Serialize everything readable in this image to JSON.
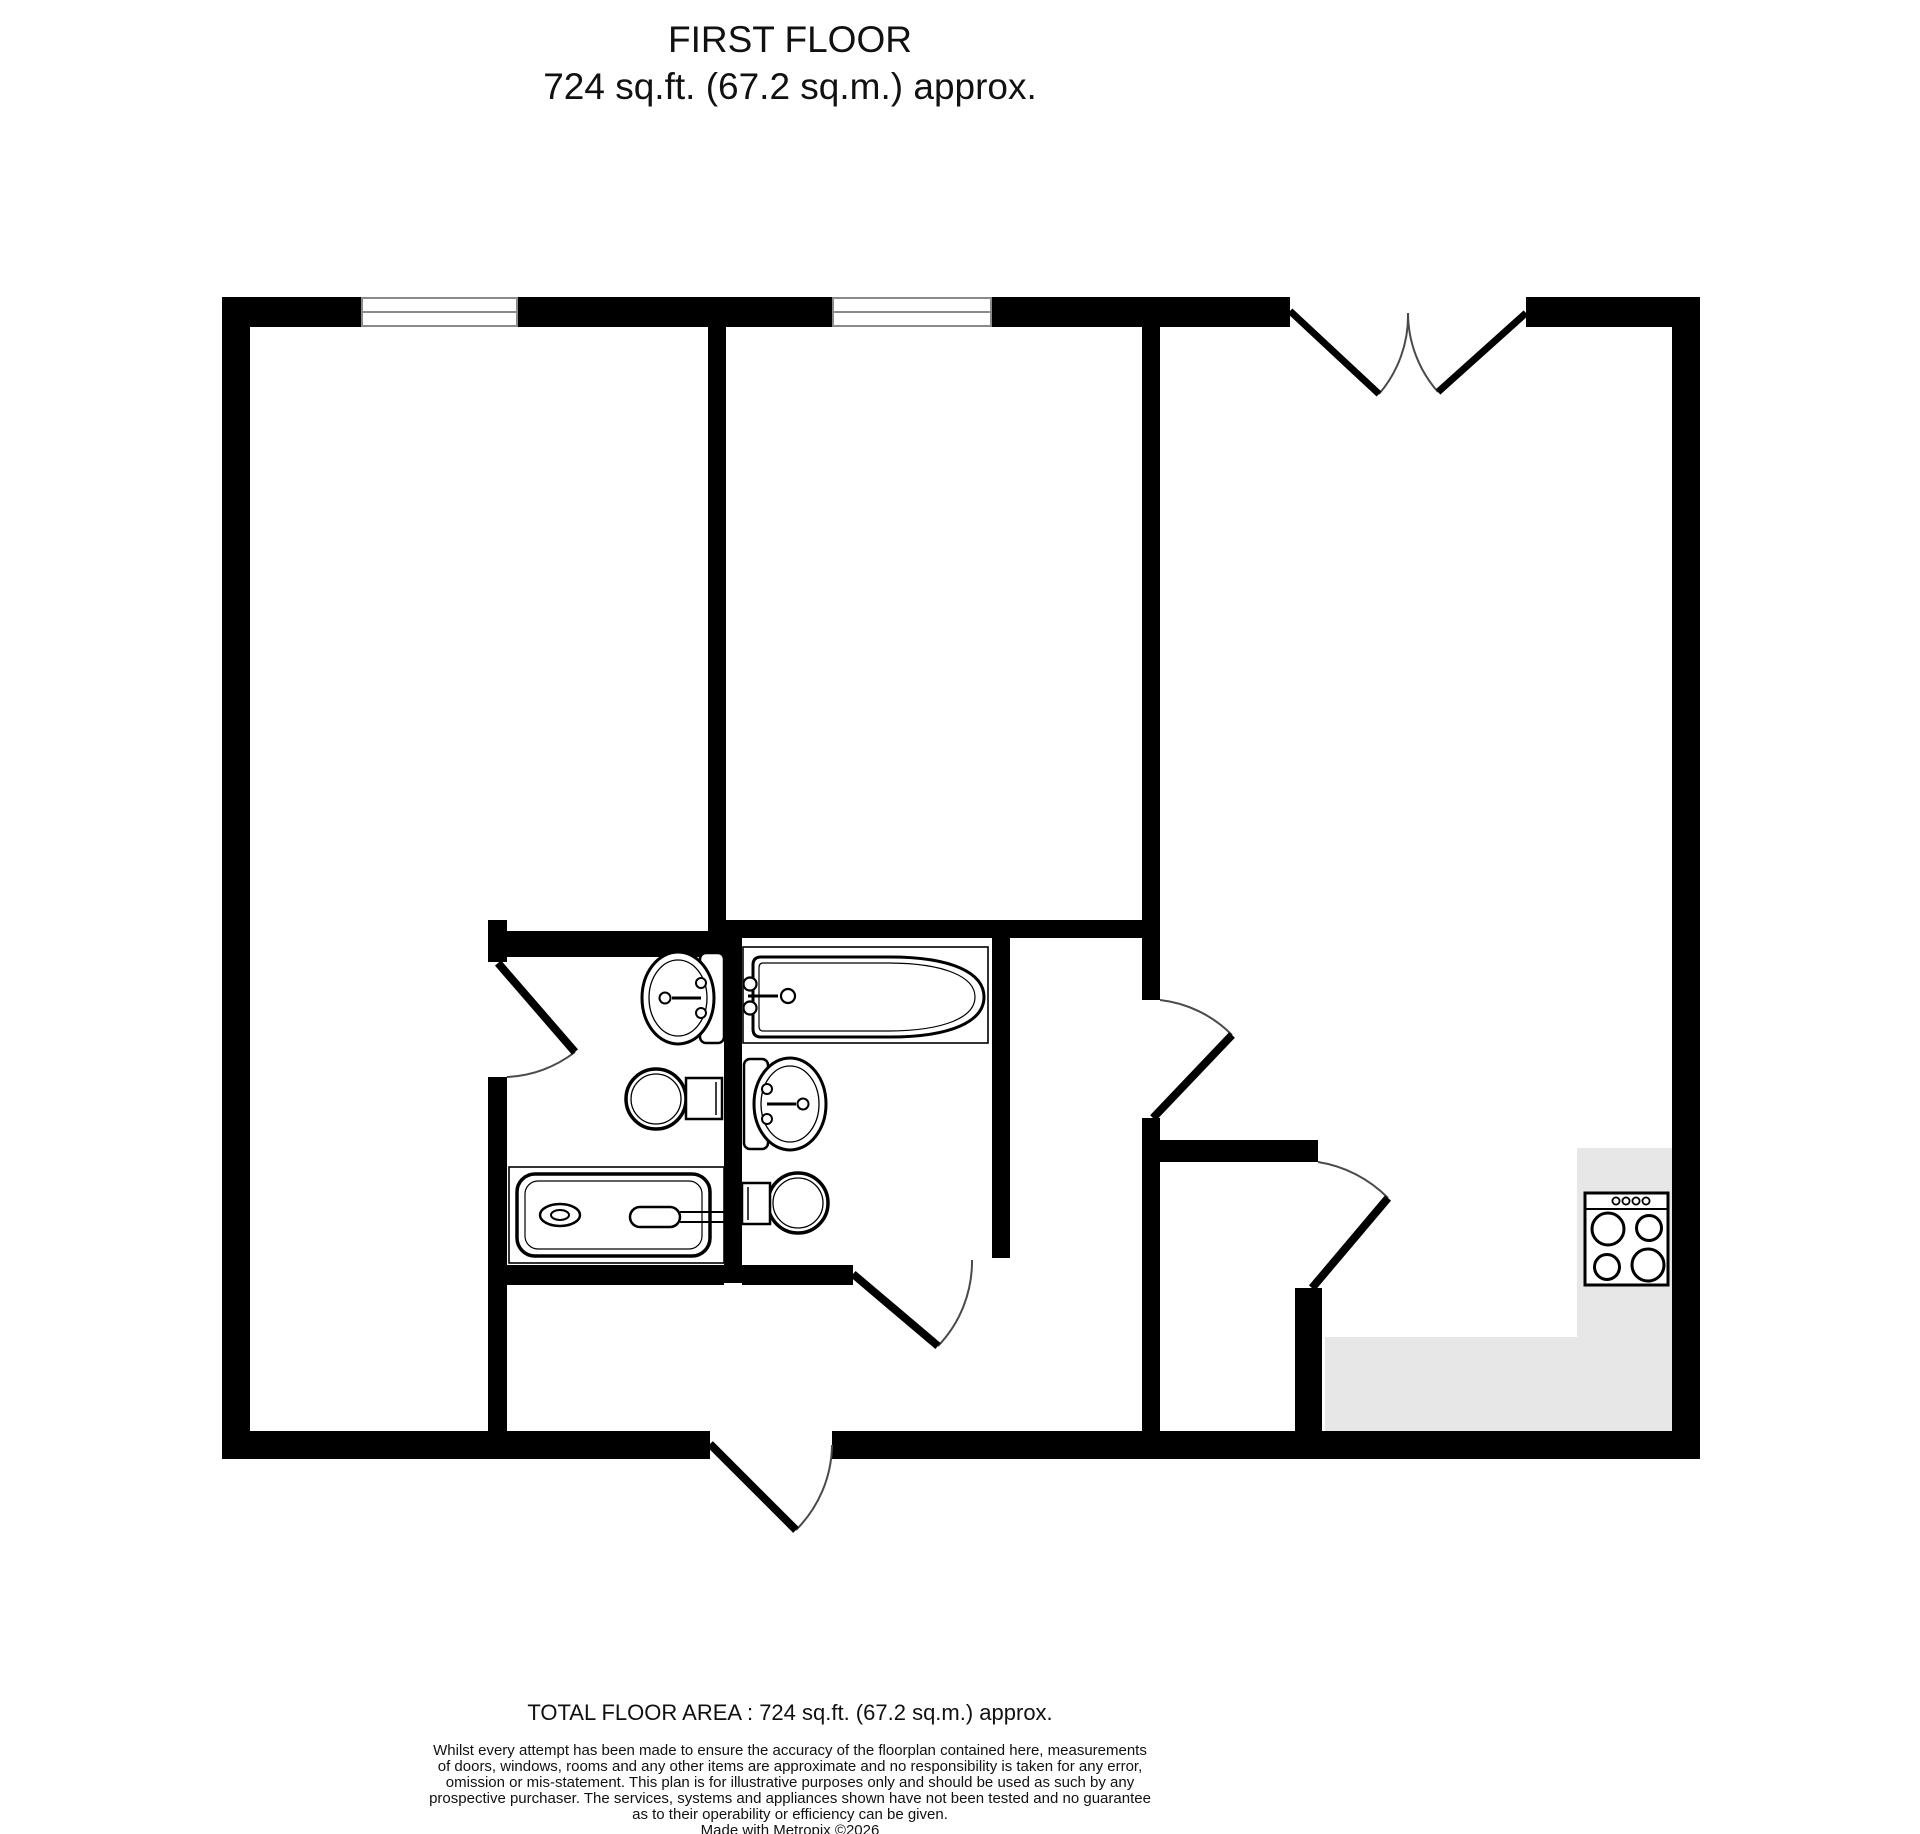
{
  "title": {
    "line1": "FIRST FLOOR",
    "line2": "724 sq.ft. (67.2 sq.m.) approx."
  },
  "footer": {
    "total": "TOTAL FLOOR AREA : 724 sq.ft. (67.2 sq.m.) approx.",
    "disclaimer_lines": [
      "Whilst every attempt has been made to ensure the accuracy of the floorplan contained here, measurements",
      "of doors, windows, rooms and any other items are approximate and no responsibility is taken for any error,",
      "omission or mis-statement. This plan is for illustrative purposes only and should be used as such by any",
      "prospective purchaser. The services, systems and appliances shown have not been tested and no guarantee",
      "as to their operability or efficiency can be given."
    ],
    "credit": "Made with Metropix ©2026"
  },
  "colors": {
    "background": "#ffffff",
    "wall": "#000000",
    "counter": "#e7e7e7",
    "window_frame": "#8a8a8a",
    "door_arc": "#4a4a4a"
  },
  "floorplan": {
    "floor_name": "FIRST FLOOR",
    "area_sqft": 724,
    "area_sqm": 67.2,
    "fixtures": [
      "bath",
      "pedestal-sink",
      "toilet",
      "shower-tray",
      "pedestal-sink",
      "toilet",
      "cooker-hob",
      "kitchen-counter"
    ],
    "features": [
      "window",
      "window",
      "double-entrance-door",
      "front-door",
      "ensuite-door",
      "bathroom-door",
      "living-room-door",
      "closet-door"
    ]
  }
}
